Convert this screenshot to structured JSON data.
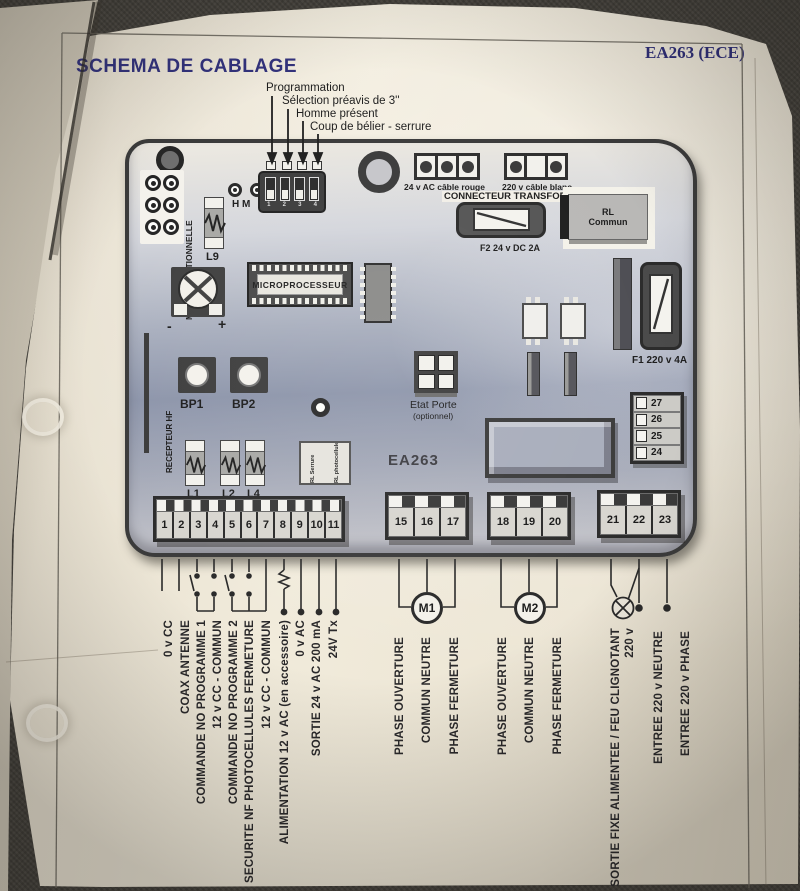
{
  "header": {
    "title": "SCHEMA DE CABLAGE",
    "doc_ref": "EA263 (ECE)"
  },
  "callouts": {
    "labels": [
      "Programmation",
      "Sélection préavis de 3''",
      "Homme présent",
      "Coup de bélier - serrure"
    ],
    "switch_numbers": [
      "1",
      "2",
      "3",
      "4"
    ]
  },
  "board": {
    "ref": "EA263",
    "module_optionnelle": "MODULE OPTIONNELLE",
    "hm": "H M",
    "l9": "L9",
    "conn_24v": "24 v AC câble rouge",
    "conn_220v": "220 v câble blanc",
    "connecteur": "CONNECTEUR TRANSFORMAT",
    "f2": "F2 24 v DC 2A",
    "rl_commun_line1": "RL",
    "rl_commun_line2": "Commun",
    "microprocesseur": "MICROPROCESSEUR",
    "f1": "F1 220 v 4A",
    "pot_minus": "-",
    "pot_plus": "+",
    "recepteur_hf": "RECEPTEUR HF",
    "bp1": "BP1",
    "bp2": "BP2",
    "l1": "L1",
    "l2": "L2",
    "l4": "L4",
    "etat_porte": "Etat Porte",
    "etat_porte_note": "(optionnel)",
    "rl_serrure": "RL Serrure",
    "rl_photocellule": "RL photocellule"
  },
  "terminals": {
    "main": [
      "1",
      "2",
      "3",
      "4",
      "5",
      "6",
      "7",
      "8",
      "9",
      "10",
      "11"
    ],
    "m1": [
      "15",
      "16",
      "17"
    ],
    "m2": [
      "18",
      "19",
      "20"
    ],
    "power": [
      "21",
      "22",
      "23"
    ],
    "aux": [
      "27",
      "26",
      "25",
      "24"
    ]
  },
  "wiring": {
    "left_labels": [
      "0 v CC",
      "COAX ANTENNE",
      "COMMANDE NO PROGRAMME 1",
      "12 v CC - COMMUN",
      "COMMANDE NO PROGRAMME 2",
      "SECURITE NF PHOTOCELLULES FERMETURE",
      "12 v CC - COMMUN",
      "ALIMENTATION 12 v AC (en accessoire)",
      "0 v AC",
      "SORTIE 24 v AC 200 mA",
      "24V Tx"
    ],
    "motor1": "M1",
    "motor1_labels": [
      "PHASE OUVERTURE",
      "COMMUN NEUTRE",
      "PHASE FERMETURE"
    ],
    "motor2": "M2",
    "motor2_labels": [
      "PHASE OUVERTURE",
      "COMMUN NEUTRE",
      "PHASE FERMETURE"
    ],
    "right_labels": [
      "SORTIE FIXE ALIMENTEE / FEU CLIGNOTANT",
      "220 v",
      "ENTREE 220 v NEUTRE",
      "ENTREE 220 v PHASE"
    ]
  },
  "colors": {
    "title_blue": "#32327c",
    "print_black": "#232323",
    "board_dark": "#3b3b3b",
    "paper": "#eee7d8"
  }
}
